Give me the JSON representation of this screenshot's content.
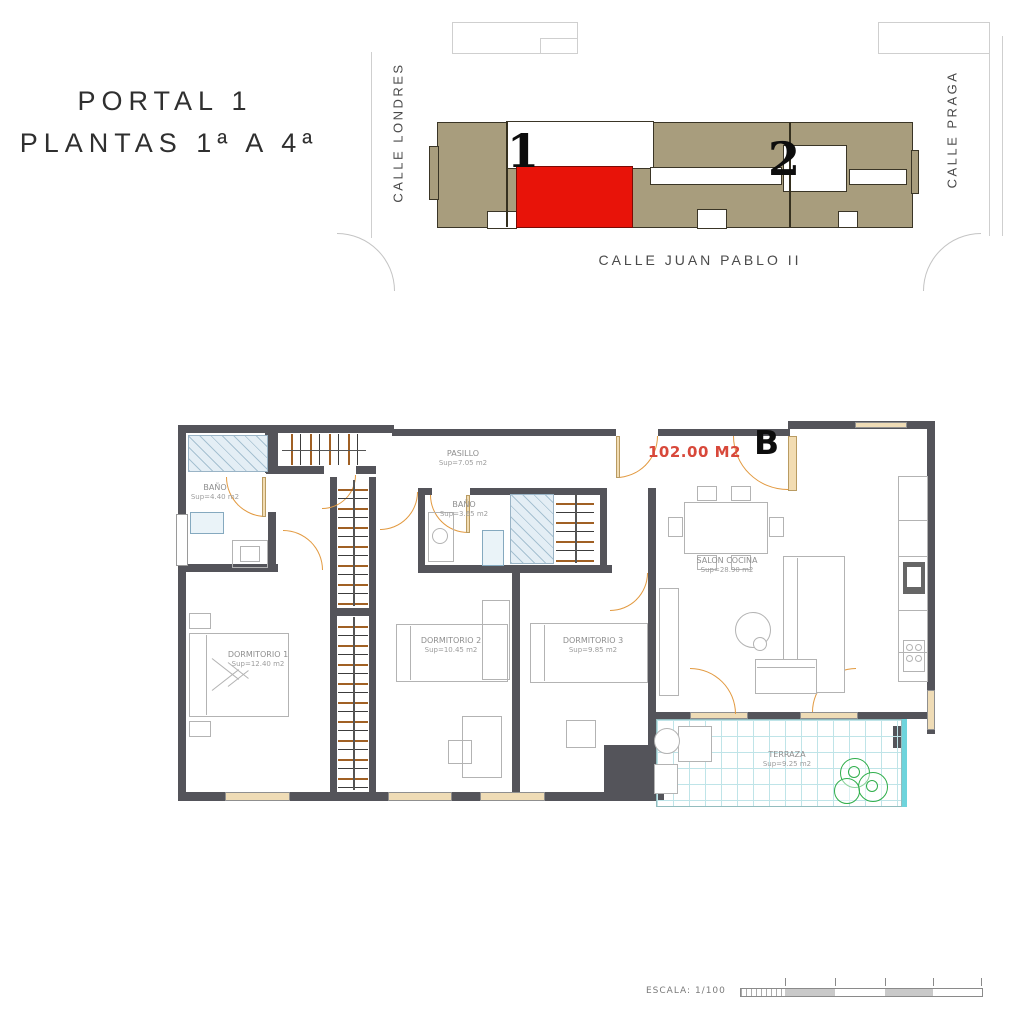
{
  "header": {
    "title_line1": "PORTAL 1",
    "title_line2": "PLANTAS 1ª A 4ª"
  },
  "site_plan": {
    "street_left": "CALLE LONDRES",
    "street_right": "CALLE PRAGA",
    "street_bottom": "CALLE JUAN PABLO II",
    "portal1_number": "1",
    "portal2_number": "2",
    "colors": {
      "building": "#a89d7d",
      "highlighted_unit": "#e81309"
    }
  },
  "floor_plan": {
    "unit": {
      "area": "102.00 M2",
      "letter": "B"
    },
    "rooms": {
      "pasillo": {
        "name": "PASILLO",
        "sup": "Sup=7.05 m2"
      },
      "bano1": {
        "name": "BAÑO",
        "sup": "Sup=4.40 m2"
      },
      "bano2": {
        "name": "BAÑO",
        "sup": "Sup=3.65 m2"
      },
      "dormitorio1": {
        "name": "DORMITORIO 1",
        "sup": "Sup=12.40 m2"
      },
      "dormitorio2": {
        "name": "DORMITORIO 2",
        "sup": "Sup=10.45 m2"
      },
      "dormitorio3": {
        "name": "DORMITORIO 3",
        "sup": "Sup=9.85 m2"
      },
      "salon": {
        "name": "SALON COCINA",
        "sup": "Sup=28.90 m2"
      },
      "terraza": {
        "name": "TERRAZA",
        "sup": "Sup=9.25 m2"
      }
    },
    "colors": {
      "wall": "#54545a",
      "door": "#e2993f",
      "terrace_tile": "#bfe4e8",
      "plant": "#2fae4a"
    }
  },
  "scale_bar": {
    "label": "ESCALA: 1/100"
  }
}
